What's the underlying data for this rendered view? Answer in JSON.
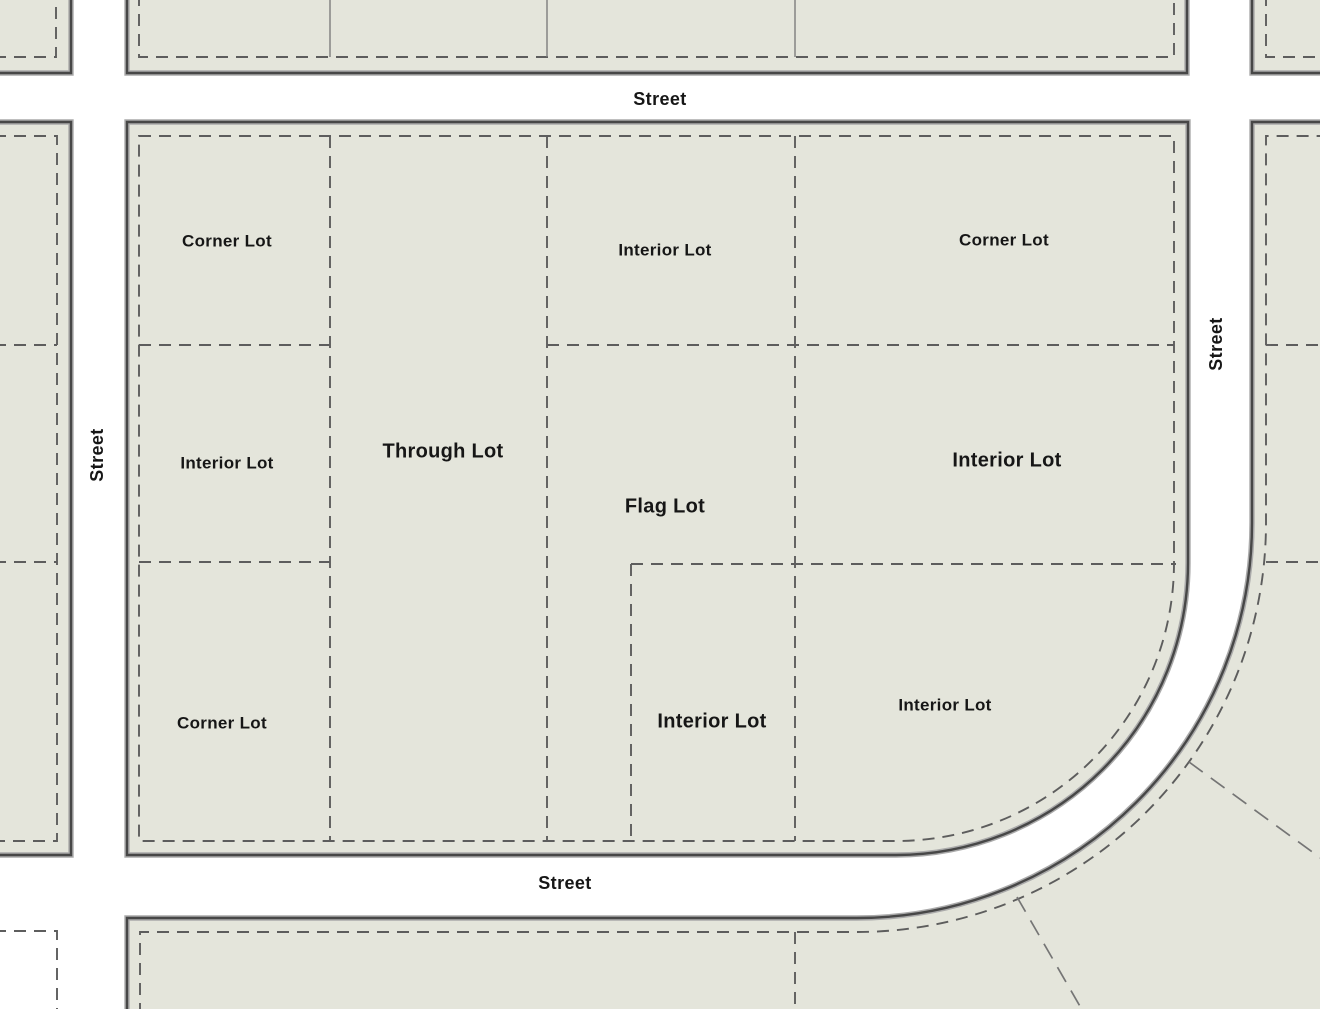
{
  "diagram": {
    "type": "lot-types-zoning-diagram",
    "colors": {
      "background": "#ffffff",
      "block_fill": "#e4e5db",
      "wall": "#474747",
      "wall_halo": "#aaaaaa",
      "lot_line": "#5d5d5d",
      "radial_line": "#757575",
      "text": "#161616"
    },
    "street_labels": [
      {
        "id": "street-label-top",
        "text": "Street",
        "x": 660,
        "y": 100,
        "rotate": 0
      },
      {
        "id": "street-label-left",
        "text": "Street",
        "x": 98,
        "y": 455,
        "rotate": -90
      },
      {
        "id": "street-label-right",
        "text": "Street",
        "x": 1217,
        "y": 344,
        "rotate": -90
      },
      {
        "id": "street-label-bottom",
        "text": "Street",
        "x": 565,
        "y": 884,
        "rotate": 0
      }
    ],
    "lot_labels": [
      {
        "id": "lot-label-corner-lot-top-left",
        "text": "Corner Lot",
        "x": 227,
        "y": 242,
        "emphasis": false
      },
      {
        "id": "lot-label-interior-lot-top",
        "text": "Interior Lot",
        "x": 665,
        "y": 251,
        "emphasis": false
      },
      {
        "id": "lot-label-corner-lot-top-right",
        "text": "Corner Lot",
        "x": 1004,
        "y": 241,
        "emphasis": false
      },
      {
        "id": "lot-label-interior-lot-left",
        "text": "Interior Lot",
        "x": 227,
        "y": 464,
        "emphasis": false
      },
      {
        "id": "lot-label-through-lot",
        "text": "Through Lot",
        "x": 443,
        "y": 452,
        "emphasis": true
      },
      {
        "id": "lot-label-flag-lot",
        "text": "Flag Lot",
        "x": 665,
        "y": 507,
        "emphasis": true
      },
      {
        "id": "lot-label-interior-lot-right",
        "text": "Interior Lot",
        "x": 1007,
        "y": 461,
        "emphasis": true
      },
      {
        "id": "lot-label-corner-lot-bottom-left",
        "text": "Corner Lot",
        "x": 222,
        "y": 724,
        "emphasis": false
      },
      {
        "id": "lot-label-interior-lot-bottom-mid",
        "text": "Interior Lot",
        "x": 712,
        "y": 722,
        "emphasis": true
      },
      {
        "id": "lot-label-interior-lot-bottom-right",
        "text": "Interior Lot",
        "x": 945,
        "y": 706,
        "emphasis": false
      }
    ],
    "label_font": {
      "regular_size": 17,
      "emphasis_size": 20,
      "street_size": 18
    }
  }
}
